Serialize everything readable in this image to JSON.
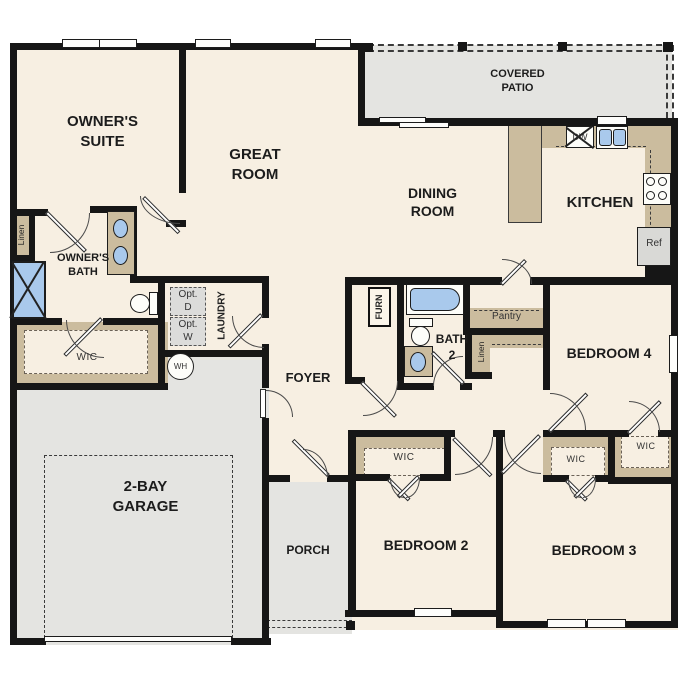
{
  "plan": {
    "rooms": {
      "owners_suite": "OWNER'S\nSUITE",
      "great_room": "GREAT\nROOM",
      "covered_patio": "COVERED\nPATIO",
      "dining_room": "DINING\nROOM",
      "kitchen": "KITCHEN",
      "owners_bath": "OWNER'S\nBATH",
      "bath_2": "BATH\n2",
      "foyer": "FOYER",
      "laundry": "LAUNDRY",
      "garage": "2-BAY\nGARAGE",
      "porch": "PORCH",
      "bedroom_2": "BEDROOM 2",
      "bedroom_3": "BEDROOM 3",
      "bedroom_4": "BEDROOM 4"
    },
    "closets": {
      "linen_owners": "Linen",
      "wic_owners": "WIC",
      "wic_bedroom_2": "WIC",
      "wic_bedroom_3": "WIC",
      "wic_bedroom_4": "WIC",
      "pantry": "Pantry",
      "linen_hall": "Linen",
      "furnace": "FURN"
    },
    "appliances": {
      "dishwasher": "DW",
      "refrigerator": "Ref",
      "water_heater": "WH",
      "optional_dryer": "Opt.\nD",
      "optional_washer": "Opt.\nW"
    },
    "colors": {
      "floor": "#f7efe2",
      "outdoor": "#e4e4e1",
      "casework": "#cbbc9e",
      "fixture_blue": "#a9c9ec",
      "wall": "#161616"
    }
  }
}
